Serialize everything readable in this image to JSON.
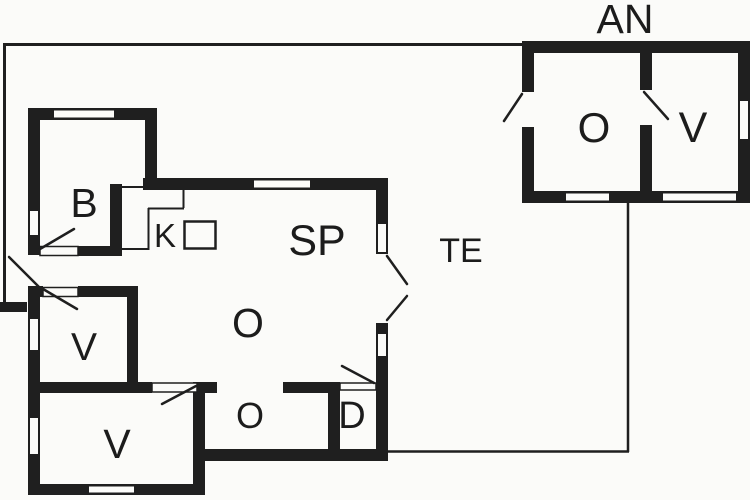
{
  "plan": {
    "annex_title": "AN",
    "rooms": {
      "b": "B",
      "k": "K",
      "sp": "SP",
      "living_o": "O",
      "hall_o": "O",
      "d": "D",
      "v1": "V",
      "v2": "V",
      "terrace": "TE",
      "annex_o": "O",
      "annex_v": "V"
    },
    "colors": {
      "wall": "#1f1f1f",
      "background": "#fbfbf9",
      "text": "#1c1c1c"
    }
  }
}
